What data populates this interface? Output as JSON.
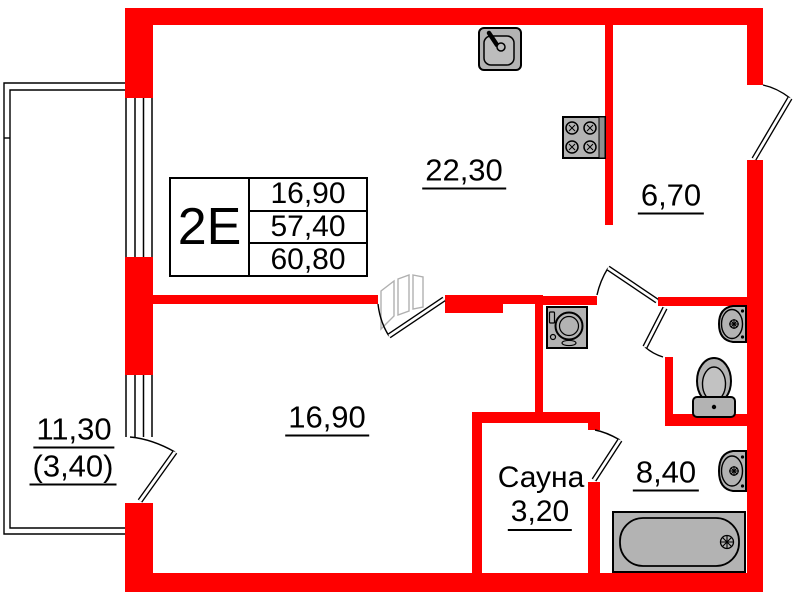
{
  "unit": {
    "label": "2Е",
    "table_rows": [
      "16,90",
      "57,40",
      "60,80"
    ]
  },
  "rooms": {
    "kitchen": {
      "area": "22,30"
    },
    "hall": {
      "area": "6,70"
    },
    "living": {
      "area": "16,90"
    },
    "sauna": {
      "name": "Сауна",
      "area": "3,20"
    },
    "bathroom": {
      "area": "8,40"
    },
    "balcony": {
      "area_full": "11,30",
      "area_counted": "(3,40)"
    }
  },
  "colors": {
    "wall": "#ff0000",
    "fixture_fill": "#b3b3b3",
    "outline": "#000000",
    "background": "#ffffff"
  }
}
